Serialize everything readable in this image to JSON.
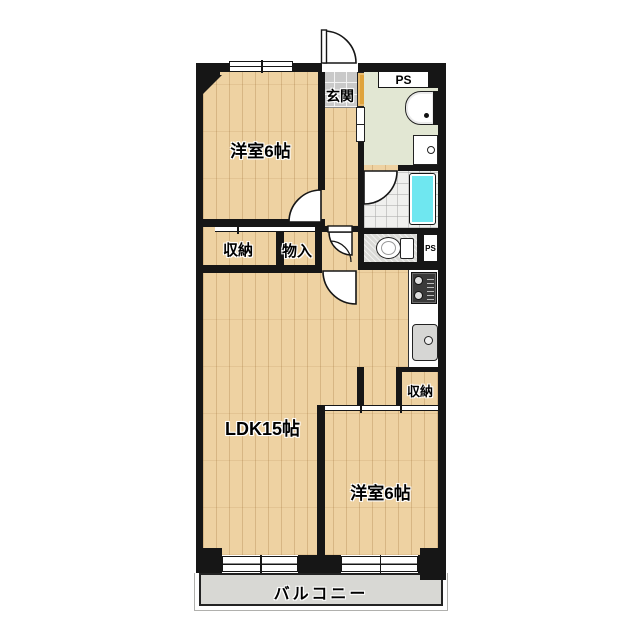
{
  "labels": {
    "genkan": "玄関",
    "ps_top": "PS",
    "western_top": "洋室6帖",
    "closet_left": "収納",
    "closet_hall": "物入",
    "ps_side": "PS",
    "closet_kitchen": "収納",
    "ldk": "LDK15帖",
    "western_bottom": "洋室6帖",
    "balcony": "バルコニー"
  },
  "colors": {
    "wall": "#161616",
    "wood": "#eed2a2",
    "genkan_tile": "#c9c9c9",
    "cabinet": "#dfa33c",
    "washroom": "#e2e7d3",
    "bath_floor": "#f0f0ee",
    "bathtub": "#6fe7f0",
    "toilet_floor": "#dadad7",
    "balcony": "#d8d8d4",
    "counter": "#ffffff",
    "stove": "#3a3a3a",
    "sink": "#d6d6d4"
  }
}
